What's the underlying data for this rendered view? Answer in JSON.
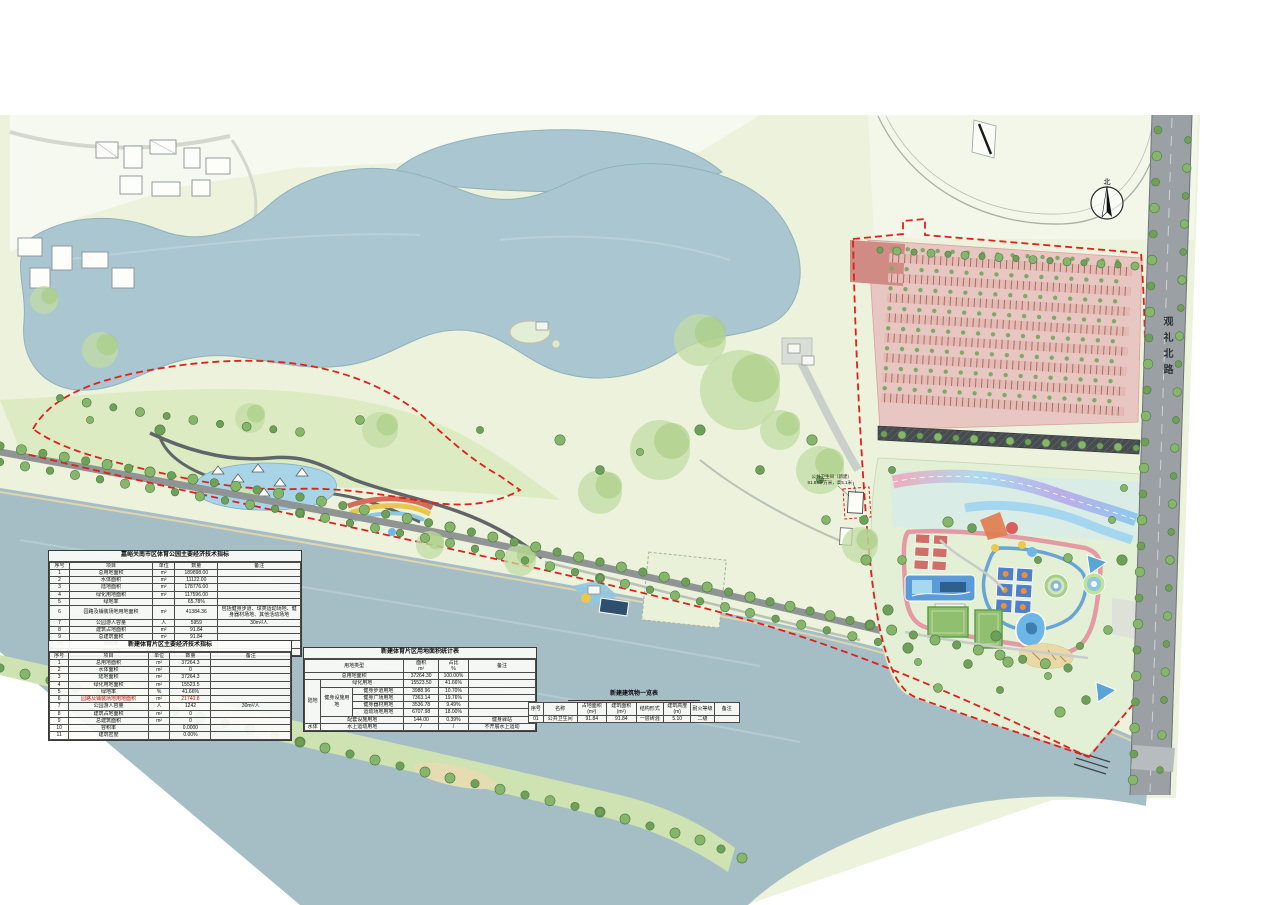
{
  "map": {
    "road_label": "观礼北路",
    "compass_label": "北",
    "toilet_annotation": [
      "公共卫生间（新建）",
      "91.84平方米，高5.1米"
    ]
  },
  "tables": {
    "park": {
      "title": "嘉峪关南市区体育公园主要经济技术指标",
      "columns": [
        "序号",
        "项目",
        "单位",
        "数量",
        "备注"
      ],
      "widths": [
        8,
        33,
        9,
        17,
        33
      ],
      "rows": [
        [
          "1",
          "总用地面积",
          "m²",
          "189898.00",
          ""
        ],
        [
          "2",
          "水体面积",
          "m²",
          "11122.00",
          ""
        ],
        [
          "3",
          "陆地面积",
          "m²",
          "178776.00",
          ""
        ],
        [
          "4",
          "绿化用地面积",
          "m²",
          "117596.00",
          ""
        ],
        [
          "5",
          "绿地率",
          "",
          "65.78%",
          ""
        ],
        [
          "6",
          "园路及铺装场地用地面积",
          "m²",
          "41384.36",
          "包括健身步道、球类运动场地、健身器材场地、其他活动场地"
        ],
        [
          "7",
          "公园游人容量",
          "人",
          "5959",
          "30m²/人"
        ],
        [
          "8",
          "建筑占地面积",
          "m²",
          "91.84",
          ""
        ],
        [
          "9",
          "总建筑面积",
          "m²",
          "91.84",
          ""
        ],
        [
          "10",
          "容积率",
          "",
          "0.0005",
          ""
        ],
        [
          "11",
          "建筑密度",
          "",
          "0.05%",
          ""
        ]
      ]
    },
    "sports": {
      "title": "新建体育片区主要经济技术指标",
      "columns": [
        "序号",
        "项目",
        "单位",
        "数量",
        "备注"
      ],
      "widths": [
        8,
        33,
        9,
        17,
        33
      ],
      "rows": [
        [
          "1",
          "总用地面积",
          "m²",
          "37264.3",
          ""
        ],
        [
          "2",
          "水体面积",
          "m²",
          "0",
          ""
        ],
        [
          "3",
          "陆地面积",
          "m²",
          "37264.3",
          ""
        ],
        [
          "4",
          "绿化用地面积",
          "m²",
          "15523.5",
          ""
        ],
        [
          "5",
          "绿地率",
          "%",
          "41.66%",
          ""
        ],
        [
          "6",
          {
            "t": "园路及铺装场地用地面积",
            "red": true
          },
          "m²",
          {
            "t": "21740.8",
            "red": true
          },
          ""
        ],
        [
          "7",
          "公园游人容量",
          "人",
          "1242",
          "30m²/人"
        ],
        [
          "8",
          "建筑占地面积",
          "m²",
          "0",
          ""
        ],
        [
          "9",
          "总建筑面积",
          "m²",
          "0",
          ""
        ],
        [
          "10",
          "容积率",
          "",
          "0.0000",
          ""
        ],
        [
          "11",
          "建筑密度",
          "",
          "0.00%",
          ""
        ]
      ]
    },
    "landuse": {
      "title": "新建体育片区用地面积统计表",
      "widths": [
        7,
        14,
        22,
        15,
        13,
        29
      ],
      "rows": [
        [
          {
            "t": "用地类型",
            "cs": 3
          },
          {
            "t": "面积\nm²"
          },
          {
            "t": "占比\n%"
          },
          {
            "t": "备注"
          }
        ],
        [
          {
            "t": "总用地面积",
            "cs": 3
          },
          "37264.30",
          "100.00%",
          ""
        ],
        [
          {
            "t": "陆地",
            "rs": 6
          },
          {
            "t": "绿化用地",
            "cs": 2
          },
          "15523.50",
          "41.66%",
          ""
        ],
        [
          {
            "t": "健身设施用地",
            "rs": 4
          },
          "健身步道用地",
          "3988.96",
          "10.70%",
          ""
        ],
        [
          "健身广场用地",
          "7363.14",
          "19.76%",
          ""
        ],
        [
          "健身器材用地",
          "3536.78",
          "9.49%",
          ""
        ],
        [
          "运动场地用地",
          "6707.98",
          "18.00%",
          ""
        ],
        [
          {
            "t": "配套设施用地",
            "cs": 2
          },
          "144.00",
          "0.39%",
          "健身驿站"
        ],
        [
          "水体",
          {
            "t": "水上运动用地",
            "cs": 2
          },
          "/",
          "/",
          "不开展水上运动"
        ]
      ]
    },
    "buildings": {
      "title": "新建建筑物一览表",
      "columns": [
        "序号",
        "名称",
        "占地面积(m²)",
        "建筑面积(m²)",
        "结构形式",
        "建筑高度(m)",
        "耐火等级",
        "备注"
      ],
      "widths": [
        7,
        16,
        14,
        14,
        13,
        13,
        11,
        12
      ],
      "rows": [
        [
          "01",
          "公共卫生间",
          "91.84",
          "91.84",
          "一层砖混",
          "5.10",
          "二级",
          ""
        ]
      ]
    }
  }
}
